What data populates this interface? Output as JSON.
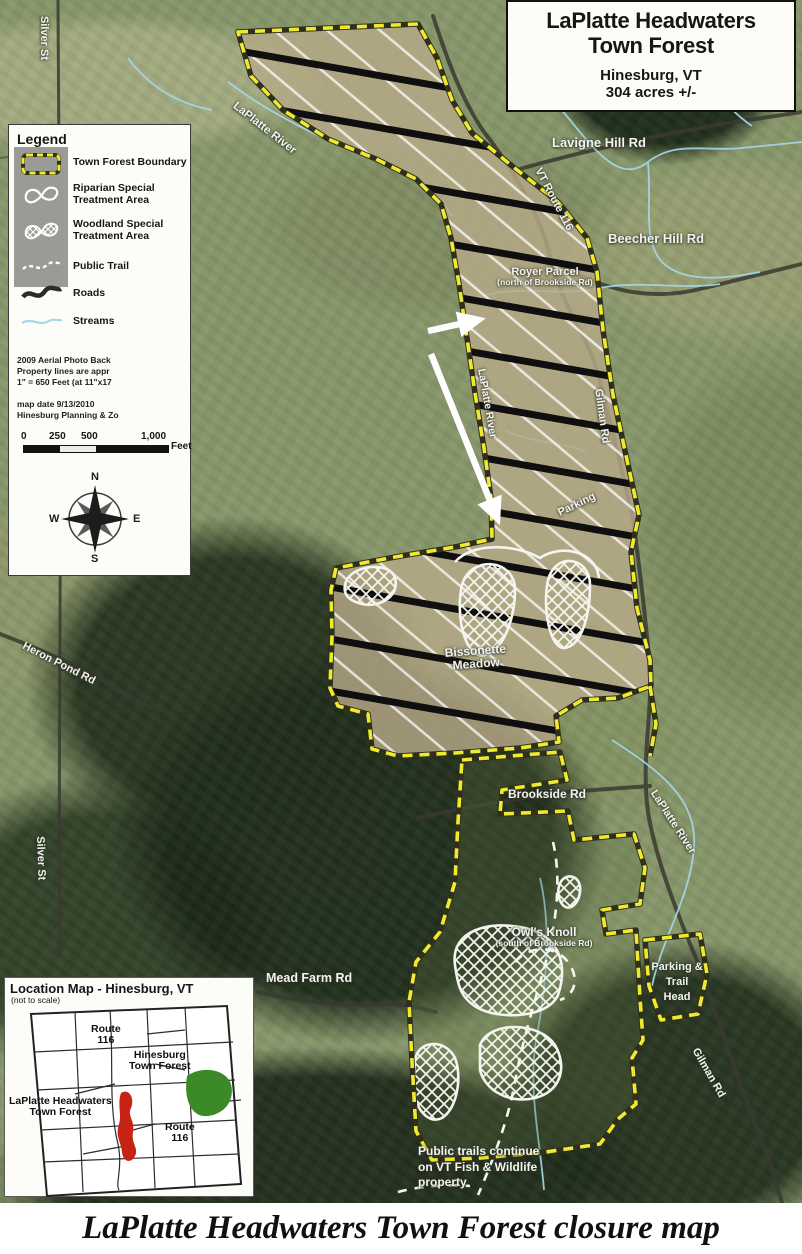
{
  "title_box": {
    "line1": "LaPlatte Headwaters",
    "line2": "Town Forest",
    "city": "Hinesburg, VT",
    "acreage": "304 acres +/-"
  },
  "legend": {
    "heading": "Legend",
    "items": {
      "boundary": "Town Forest Boundary",
      "riparian_1": "Riparian Special",
      "riparian_2": "Treatment Area",
      "woodland_1": "Woodland Special",
      "woodland_2": "Treatment Area",
      "trail": "Public Trail",
      "roads": "Roads",
      "streams": "Streams"
    },
    "notes": {
      "n1": "2009 Aerial Photo Back",
      "n2": "Property lines are appr",
      "n3": "1\" = 650 Feet (at 11\"x17",
      "n4": "map date 9/13/2010",
      "n5": "Hinesburg Planning & Zo"
    },
    "scale": {
      "t0": "0",
      "t1": "250",
      "t2": "500",
      "t3": "1,000",
      "unit": "Feet"
    },
    "compass": {
      "n": "N",
      "e": "E",
      "s": "S",
      "w": "W"
    }
  },
  "callout": {
    "text": "The hash marked area is open only to deer hunting from October 25th through December 14th."
  },
  "map_labels": {
    "silver_st_top": "Silver St",
    "laplatte_river_top": "LaPlatte River",
    "lavigne_hill_rd": "Lavigne Hill Rd",
    "vt_route_116": "VT Route 116",
    "beecher_hill_rd": "Beecher Hill Rd",
    "royer_parcel_1": "Royer Parcel",
    "royer_parcel_2": "(north of Brookside Rd)",
    "laplatte_river_mid": "LaPlatte River",
    "gilman_rd_mid": "Gilman Rd",
    "parking": "Parking",
    "bissonette_1": "Bissonette",
    "bissonette_2": "Meadow",
    "heron_pond_rd": "Heron Pond Rd",
    "brookside_rd": "Brookside Rd",
    "laplatte_river_right": "LaPlatte River",
    "silver_st_bottom": "Silver St",
    "owls_knoll_1": "Owl's Knoll",
    "owls_knoll_2": "(south of Brookside Rd)",
    "mead_farm_rd": "Mead Farm Rd",
    "pth_1": "Parking &",
    "pth_2": "Trail",
    "pth_3": "Head",
    "gilman_rd_bottom": "Gilman Rd",
    "trails_note_1": "Public trails continue",
    "trails_note_2": "on VT Fish & Wildlife",
    "trails_note_3": "property"
  },
  "location_map": {
    "title": "Location Map - Hinesburg, VT",
    "subtitle": "(not to scale)",
    "route116_top_1": "Route",
    "route116_top_2": "116",
    "hinesburg_1": "Hinesburg",
    "hinesburg_2": "Town Forest",
    "laplatte_1": "LaPlatte Headwaters",
    "laplatte_2": "Town Forest",
    "route116_bot_1": "Route",
    "route116_bot_2": "116"
  },
  "caption": "LaPlatte Headwaters Town Forest closure map",
  "colors": {
    "boundary_yellow": "#f0ea2e",
    "hash_black": "#0f0f0f",
    "stream_blue": "#a5d8ea",
    "field_tan": "#b7aa88",
    "location_red": "#c62314",
    "location_green": "#3c8a27"
  }
}
